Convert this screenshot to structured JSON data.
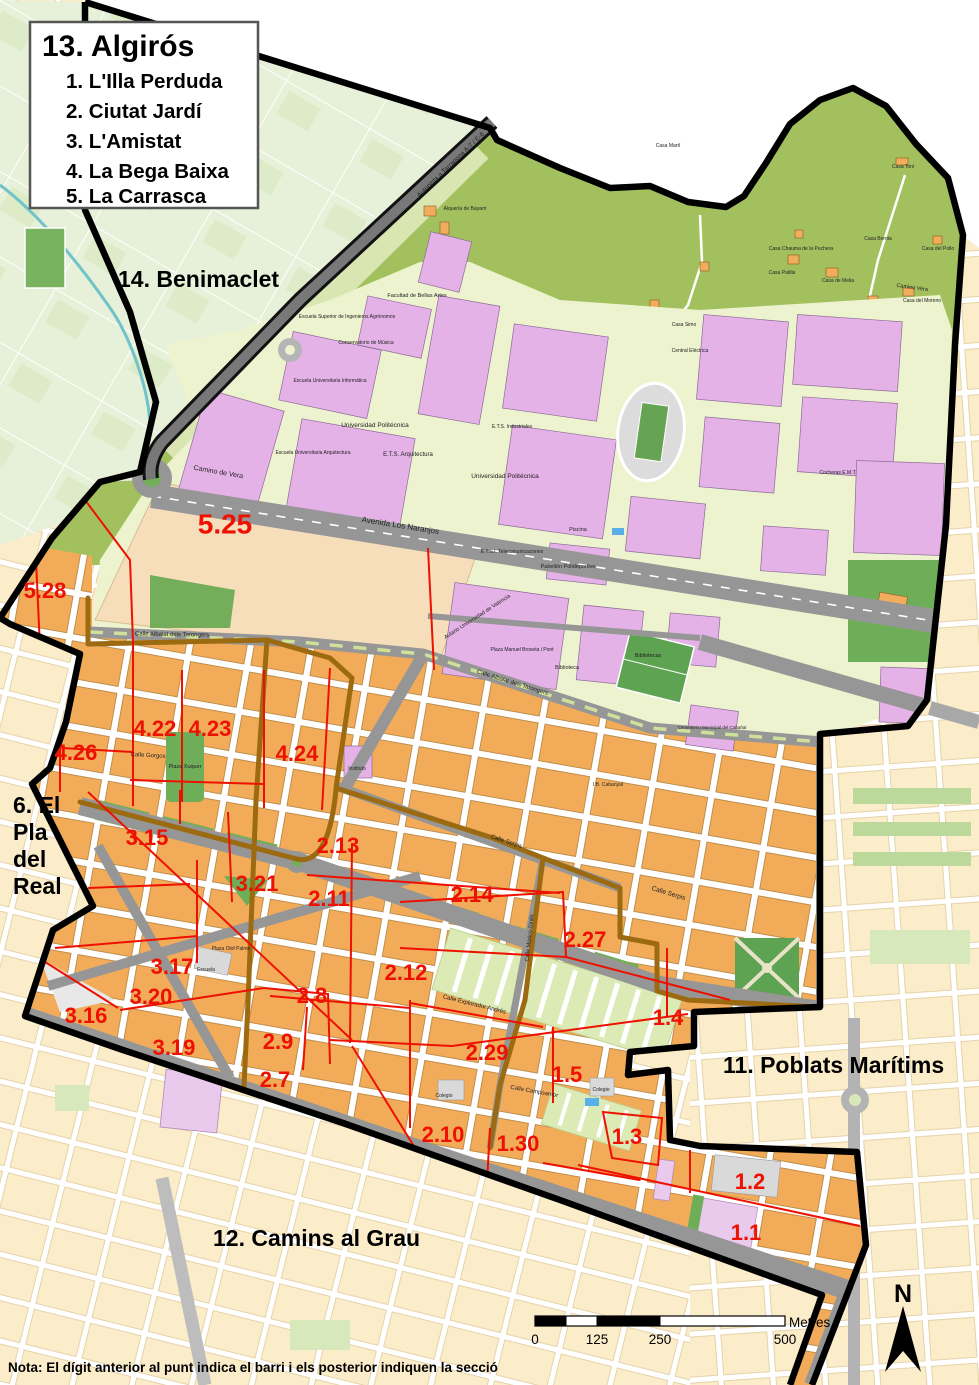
{
  "title_box": {
    "title": "13. Algirós",
    "items": [
      "1. L'Illa Perduda",
      "2. Ciutat Jardí",
      "3. L'Amistat",
      "4. La Bega Baixa",
      "5. La Carrasca"
    ]
  },
  "adjacent_districts": [
    {
      "id": "benimaclet",
      "lines": [
        "14. Benimaclet"
      ],
      "x": 118,
      "y": 287,
      "lh": 27
    },
    {
      "id": "pla-del-real",
      "lines": [
        "6. El",
        "Pla",
        "del",
        "Real"
      ],
      "x": 13,
      "y": 813,
      "lh": 27
    },
    {
      "id": "poblats-maritims",
      "lines": [
        "11. Poblats Marítims"
      ],
      "x": 723,
      "y": 1073,
      "lh": 27
    },
    {
      "id": "camins-al-grau",
      "lines": [
        "12. Camins al Grau"
      ],
      "x": 213,
      "y": 1246,
      "lh": 27
    }
  ],
  "sections": [
    {
      "label": "5.25",
      "x": 225,
      "y": 526,
      "s": 28
    },
    {
      "label": "5.28",
      "x": 45,
      "y": 592,
      "s": 22
    },
    {
      "label": "4.22",
      "x": 155,
      "y": 730,
      "s": 22
    },
    {
      "label": "4.23",
      "x": 210,
      "y": 730,
      "s": 22
    },
    {
      "label": "4.26",
      "x": 76,
      "y": 754,
      "s": 22
    },
    {
      "label": "4.24",
      "x": 297,
      "y": 755,
      "s": 22
    },
    {
      "label": "3.15",
      "x": 147,
      "y": 839,
      "s": 22
    },
    {
      "label": "2.13",
      "x": 338,
      "y": 847,
      "s": 22
    },
    {
      "label": "3.21",
      "x": 257,
      "y": 885,
      "s": 22
    },
    {
      "label": "2.11",
      "x": 329,
      "y": 900,
      "s": 22
    },
    {
      "label": "2.14",
      "x": 472,
      "y": 896,
      "s": 22
    },
    {
      "label": "2.27",
      "x": 585,
      "y": 941,
      "s": 22
    },
    {
      "label": "3.17",
      "x": 172,
      "y": 968,
      "s": 22
    },
    {
      "label": "2.12",
      "x": 406,
      "y": 974,
      "s": 22
    },
    {
      "label": "3.20",
      "x": 151,
      "y": 998,
      "s": 22
    },
    {
      "label": "2.8",
      "x": 312,
      "y": 997,
      "s": 22
    },
    {
      "label": "3.16",
      "x": 86,
      "y": 1017,
      "s": 22
    },
    {
      "label": "1.4",
      "x": 668,
      "y": 1019,
      "s": 22
    },
    {
      "label": "2.9",
      "x": 278,
      "y": 1043,
      "s": 22
    },
    {
      "label": "3.19",
      "x": 174,
      "y": 1049,
      "s": 22
    },
    {
      "label": "2.29",
      "x": 487,
      "y": 1054,
      "s": 22
    },
    {
      "label": "1.5",
      "x": 567,
      "y": 1076,
      "s": 22
    },
    {
      "label": "2.7",
      "x": 275,
      "y": 1081,
      "s": 22
    },
    {
      "label": "2.10",
      "x": 443,
      "y": 1136,
      "s": 22
    },
    {
      "label": "1.30",
      "x": 518,
      "y": 1145,
      "s": 22
    },
    {
      "label": "1.3",
      "x": 627,
      "y": 1138,
      "s": 22
    },
    {
      "label": "1.2",
      "x": 750,
      "y": 1183,
      "s": 22
    },
    {
      "label": "1.1",
      "x": 746,
      "y": 1234,
      "s": 22
    }
  ],
  "map_labels": [
    {
      "t": "Autopista a Tarragona  A-7 / E-6",
      "x": 452,
      "y": 166,
      "r": -44,
      "s": 6.5
    },
    {
      "t": "Camino de Vera",
      "x": 218,
      "y": 474,
      "r": 10,
      "s": 7
    },
    {
      "t": "Avenida Los Naranjos",
      "x": 400,
      "y": 528,
      "r": 9,
      "s": 8
    },
    {
      "t": "Calle Albalat dels Tarongers",
      "x": 172,
      "y": 636,
      "r": 1,
      "s": 6
    },
    {
      "t": "Calle Albalat dels Tarongers",
      "x": 512,
      "y": 684,
      "r": 17,
      "s": 6
    },
    {
      "t": "Calle Serpis",
      "x": 506,
      "y": 843,
      "r": 18,
      "s": 6
    },
    {
      "t": "Calle Serpis",
      "x": 668,
      "y": 895,
      "r": 17,
      "s": 6.5
    },
    {
      "t": "Calle Gorgos",
      "x": 148,
      "y": 757,
      "r": 3,
      "s": 6
    },
    {
      "t": "Plaza Xuquer",
      "x": 185,
      "y": 768,
      "r": 0,
      "s": 5.5
    },
    {
      "t": "Calle Músico Ginés",
      "x": 531,
      "y": 938,
      "r": -84,
      "s": 5.5
    },
    {
      "t": "Calle Campoamor",
      "x": 534,
      "y": 1093,
      "r": 10,
      "s": 6
    },
    {
      "t": "Calle Explorador Andrés",
      "x": 474,
      "y": 1006,
      "r": 14,
      "s": 6
    },
    {
      "t": "Camino Vera",
      "x": 912,
      "y": 289,
      "r": 8,
      "s": 5.5
    },
    {
      "t": "Universidad Politécnica",
      "x": 375,
      "y": 427,
      "r": 0,
      "s": 6.5
    },
    {
      "t": "Universidad Politécnica",
      "x": 505,
      "y": 478,
      "r": 0,
      "s": 6.5
    },
    {
      "t": "E.T.S. Arquitectura",
      "x": 408,
      "y": 456,
      "r": 0,
      "s": 6
    },
    {
      "t": "Facultad de Bellas Artes",
      "x": 417,
      "y": 297,
      "r": 0,
      "s": 5.5
    },
    {
      "t": "Escuela Universitaria Arquitectura",
      "x": 313,
      "y": 454,
      "r": 0,
      "s": 5
    },
    {
      "t": "Escuela Universitaria Informática",
      "x": 330,
      "y": 382,
      "r": 0,
      "s": 5
    },
    {
      "t": "Conservatorio de Música",
      "x": 366,
      "y": 344,
      "r": 0,
      "s": 5
    },
    {
      "t": "Escuela Superior de Ingenieros Agrónomos",
      "x": 347,
      "y": 318,
      "r": 0,
      "s": 5
    },
    {
      "t": "E.T.S.I. Telecomunicaciones",
      "x": 512,
      "y": 553,
      "r": 0,
      "s": 5
    },
    {
      "t": "E.T.S. Industriales",
      "x": 512,
      "y": 428,
      "r": 0,
      "s": 5
    },
    {
      "t": "Pabellón Polideportivo",
      "x": 568,
      "y": 568,
      "r": 0,
      "s": 5.5
    },
    {
      "t": "Piscina",
      "x": 578,
      "y": 531,
      "r": 0,
      "s": 5.5
    },
    {
      "t": "Cocheras E.M.T.",
      "x": 838,
      "y": 474,
      "r": 0,
      "s": 5
    },
    {
      "t": "Aulario Universidad de Valencia",
      "x": 478,
      "y": 618,
      "r": -33,
      "s": 5.5
    },
    {
      "t": "Plaza Manuel Broseta i Pont",
      "x": 522,
      "y": 651,
      "r": 0,
      "s": 5
    },
    {
      "t": "Biblioteca",
      "x": 567,
      "y": 669,
      "r": 0,
      "s": 5.5
    },
    {
      "t": "Bibliotecas",
      "x": 648,
      "y": 657,
      "r": 0,
      "s": 5.5
    },
    {
      "t": "Cementerio Municipal del Cabañal",
      "x": 712,
      "y": 729,
      "r": 0,
      "s": 4.5
    },
    {
      "t": "Instituto",
      "x": 357,
      "y": 770,
      "r": 0,
      "s": 5
    },
    {
      "t": "I.B. Cabanyal",
      "x": 608,
      "y": 786,
      "r": 0,
      "s": 5
    },
    {
      "t": "Escuela",
      "x": 206,
      "y": 971,
      "r": 0,
      "s": 5
    },
    {
      "t": "Plaza Olof Palme",
      "x": 231,
      "y": 950,
      "r": 0,
      "s": 5
    },
    {
      "t": "Colegio",
      "x": 444,
      "y": 1097,
      "r": 0,
      "s": 5
    },
    {
      "t": "Colegio",
      "x": 601,
      "y": 1091,
      "r": 0,
      "s": 5
    },
    {
      "t": "Casa Martí",
      "x": 668,
      "y": 147,
      "r": 0,
      "s": 5
    },
    {
      "t": "Casa Toni",
      "x": 903,
      "y": 168,
      "r": 0,
      "s": 5
    },
    {
      "t": "Alquería de Bayarri",
      "x": 465,
      "y": 210,
      "r": 0,
      "s": 5
    },
    {
      "t": "Casa Chauma de la Puchera",
      "x": 801,
      "y": 250,
      "r": 0,
      "s": 5
    },
    {
      "t": "Casa Patilla",
      "x": 782,
      "y": 274,
      "r": 0,
      "s": 5
    },
    {
      "t": "Casa de Melia",
      "x": 838,
      "y": 282,
      "r": 0,
      "s": 5
    },
    {
      "t": "Casa Bernia",
      "x": 878,
      "y": 240,
      "r": 0,
      "s": 5
    },
    {
      "t": "Casa del Pollo",
      "x": 938,
      "y": 250,
      "r": 0,
      "s": 5
    },
    {
      "t": "Casa del Moreno",
      "x": 922,
      "y": 302,
      "r": 0,
      "s": 5
    },
    {
      "t": "Casa Simo",
      "x": 684,
      "y": 326,
      "r": 0,
      "s": 5
    },
    {
      "t": "Central Eléctrica",
      "x": 690,
      "y": 352,
      "r": 0,
      "s": 5
    }
  ],
  "scale_bar": {
    "ticks": [
      "0",
      "125",
      "250",
      "500"
    ],
    "unit": "Metres"
  },
  "north_label": "N",
  "note": "Nota: El dígit anterior al punt indica el barri i els posterior indiquen la secció",
  "colors": {
    "section_label": "#ee1000",
    "section_line": "#ee1000",
    "barri_line": "#9c6a10",
    "district_boundary": "#000000",
    "park_green": "#a3c05e",
    "campus_lavender": "#e5b2e8",
    "campus_base": "#eef3cf",
    "residential_orange": "#f2ac59",
    "outside_cream": "#fbecca",
    "road_grey": "#969696",
    "water_blue": "#4a90d9"
  }
}
